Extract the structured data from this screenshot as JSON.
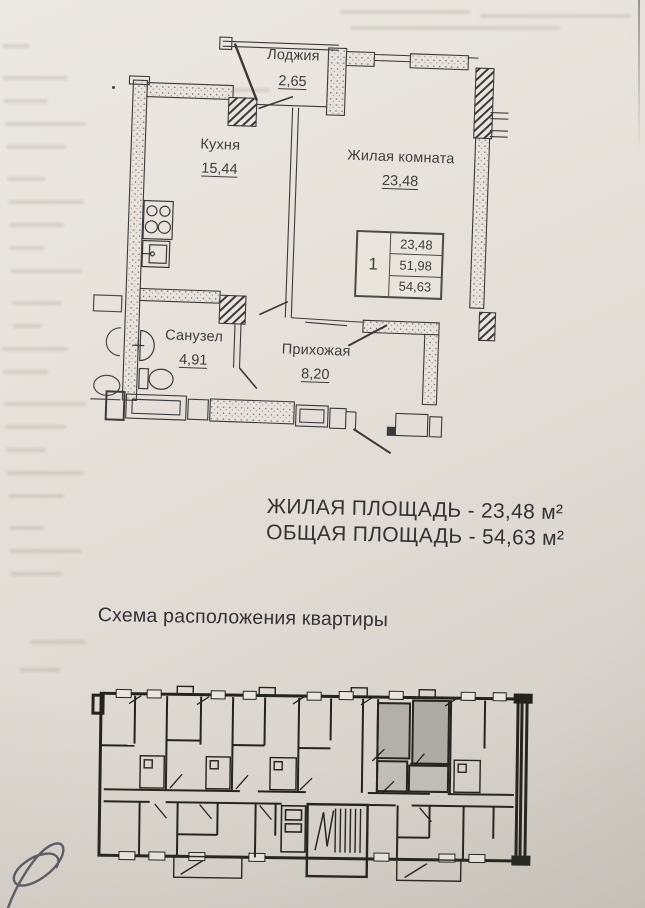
{
  "colors": {
    "paper": "#e4dfd8",
    "ink": "#3b3b3b",
    "building_ink": "#24241f",
    "highlight_gray": "#b3b0a9",
    "highlight_gray_light": "#c1beb7",
    "signature_ink": "#43465200"
  },
  "plan": {
    "rooms": [
      {
        "name": "Лоджия",
        "area": "2,65"
      },
      {
        "name": "Кухня",
        "area": "15,44"
      },
      {
        "name": "Жилая комната",
        "area": "23,48"
      },
      {
        "name": "Санузел",
        "area": "4,91"
      },
      {
        "name": "Прихожая",
        "area": "8,20"
      }
    ],
    "stamp": {
      "rooms_count": "1",
      "values": [
        "23,48",
        "51,98",
        "54,63"
      ]
    }
  },
  "summary": {
    "living": "ЖИЛАЯ ПЛОЩАДЬ - 23,48 м²",
    "total": "ОБЩАЯ ПЛОЩАДЬ - 54,63 м²"
  },
  "scheme": {
    "title": "Схема расположения квартиры"
  },
  "icons": [
    "stove-icon",
    "kitchen-sink-icon",
    "washbasin-icon",
    "toilet-icon",
    "vent-shaft-hatch-icon",
    "stairs-icon",
    "elevator-icon",
    "signature-mark"
  ]
}
